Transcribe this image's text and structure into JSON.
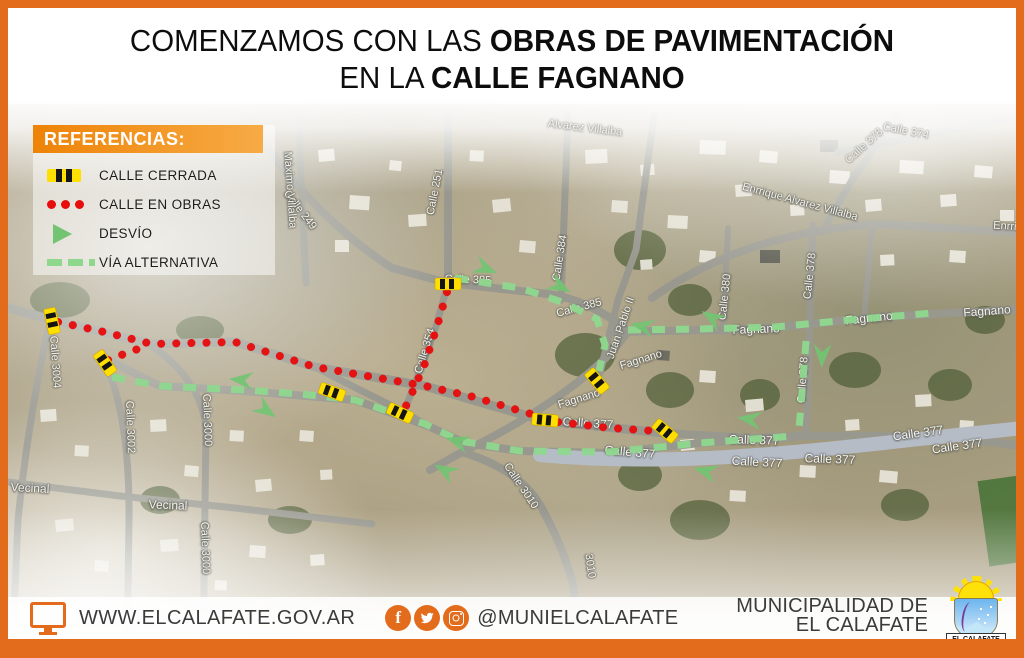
{
  "header": {
    "title_line1_regular": "COMENZAMOS CON LAS ",
    "title_line1_bold": "OBRAS DE PAVIMENTACIÓN",
    "title_line2_regular": "EN LA ",
    "title_line2_bold": "CALLE FAGNANO"
  },
  "legend": {
    "title": "REFERENCIAS:",
    "items": [
      {
        "type": "closed",
        "label": "CALLE CERRADA"
      },
      {
        "type": "works",
        "label": "CALLE EN OBRAS"
      },
      {
        "type": "detour",
        "label": "DESVÍO"
      },
      {
        "type": "alternative",
        "label": "VÍA ALTERNATIVA"
      }
    ]
  },
  "colors": {
    "accent_orange": "#e26b1c",
    "closed_yellow": "#ffdf00",
    "works_red": "#e60d0d",
    "detour_green": "#72c472",
    "alternative_green": "#8ed88e"
  },
  "map": {
    "street_labels": [
      {
        "t": "Calle 249",
        "x": 300,
        "y": 210,
        "r": 52
      },
      {
        "t": "Máximo Villalba",
        "x": 290,
        "y": 190,
        "r": 86
      },
      {
        "t": "Calle 251",
        "x": 435,
        "y": 192,
        "r": -79
      },
      {
        "t": "Calle 384",
        "x": 560,
        "y": 258,
        "r": -81
      },
      {
        "t": "Alvarez Villalba",
        "x": 585,
        "y": 128,
        "r": 7,
        "f": 1
      },
      {
        "t": "Calle 374",
        "x": 906,
        "y": 131,
        "r": 11,
        "f": 1
      },
      {
        "t": "Calle 378",
        "x": 864,
        "y": 146,
        "r": -42,
        "f": 1
      },
      {
        "t": "Enrrique Alvarez Villalba",
        "x": 800,
        "y": 202,
        "r": 15
      },
      {
        "t": "Enrrique",
        "x": 1014,
        "y": 227,
        "r": 4
      },
      {
        "t": "Calle 380",
        "x": 725,
        "y": 297,
        "r": -84
      },
      {
        "t": "Calle 378",
        "x": 810,
        "y": 276,
        "r": -84
      },
      {
        "t": "Calle 378",
        "x": 803,
        "y": 380,
        "r": -86
      },
      {
        "t": "Juan Pablo II",
        "x": 621,
        "y": 328,
        "r": -71
      },
      {
        "t": "Calle 385",
        "x": 468,
        "y": 280,
        "r": 2
      },
      {
        "t": "Calle 385",
        "x": 579,
        "y": 308,
        "r": -15
      },
      {
        "t": "Fagnano",
        "x": 756,
        "y": 329,
        "r": -2,
        "s": 12
      },
      {
        "t": "Fagnano",
        "x": 869,
        "y": 318,
        "r": -6,
        "s": 12
      },
      {
        "t": "Fagnano",
        "x": 987,
        "y": 311,
        "r": -4,
        "s": 12
      },
      {
        "t": "Fagnano",
        "x": 579,
        "y": 399,
        "r": -17
      },
      {
        "t": "Fagnano",
        "x": 641,
        "y": 360,
        "r": -17
      },
      {
        "t": "Calle 354",
        "x": 425,
        "y": 351,
        "r": -73
      },
      {
        "t": "Calle 377",
        "x": 588,
        "y": 423,
        "r": 4,
        "s": 12
      },
      {
        "t": "Calle 377",
        "x": 630,
        "y": 452,
        "r": 5,
        "s": 12
      },
      {
        "t": "Calle 377",
        "x": 754,
        "y": 440,
        "r": 2,
        "s": 12
      },
      {
        "t": "Calle 377",
        "x": 757,
        "y": 462,
        "r": 3,
        "s": 12
      },
      {
        "t": "Calle 377",
        "x": 830,
        "y": 459,
        "r": 2,
        "s": 12
      },
      {
        "t": "Calle 377",
        "x": 918,
        "y": 433,
        "r": -8,
        "s": 12
      },
      {
        "t": "Calle 377",
        "x": 957,
        "y": 446,
        "r": -8,
        "s": 12
      },
      {
        "t": "Calle 3004",
        "x": 55,
        "y": 362,
        "r": 86
      },
      {
        "t": "Calle 3002",
        "x": 130,
        "y": 427,
        "r": 88
      },
      {
        "t": "Calle 3000",
        "x": 207,
        "y": 420,
        "r": 88
      },
      {
        "t": "Calle 3000",
        "x": 205,
        "y": 548,
        "r": 88
      },
      {
        "t": "Vecinal",
        "x": 30,
        "y": 488,
        "r": 3,
        "s": 12
      },
      {
        "t": "Vecinal",
        "x": 168,
        "y": 505,
        "r": 2,
        "s": 12
      },
      {
        "t": "Calle 3010",
        "x": 521,
        "y": 486,
        "r": 56
      },
      {
        "t": "3010",
        "x": 590,
        "y": 566,
        "r": 82
      }
    ],
    "closures": [
      {
        "x": 52,
        "y": 321,
        "r": 78
      },
      {
        "x": 105,
        "y": 363,
        "r": 55
      },
      {
        "x": 332,
        "y": 392,
        "r": 20
      },
      {
        "x": 400,
        "y": 413,
        "r": 25
      },
      {
        "x": 448,
        "y": 284,
        "r": 0
      },
      {
        "x": 545,
        "y": 420,
        "r": 5
      },
      {
        "x": 665,
        "y": 431,
        "r": 40
      },
      {
        "x": 597,
        "y": 381,
        "r": 50
      }
    ],
    "works_routes": [
      [
        [
          58,
          322
        ],
        [
          100,
          331
        ],
        [
          152,
          344
        ],
        [
          235,
          342
        ],
        [
          315,
          367
        ],
        [
          425,
          386
        ],
        [
          470,
          396
        ],
        [
          538,
          416
        ]
      ],
      [
        [
          558,
          422
        ],
        [
          610,
          428
        ],
        [
          656,
          431
        ]
      ],
      [
        [
          108,
          360
        ],
        [
          132,
          351
        ],
        [
          150,
          345
        ]
      ],
      [
        [
          447,
          292
        ],
        [
          436,
          330
        ],
        [
          424,
          366
        ],
        [
          412,
          393
        ],
        [
          405,
          408
        ]
      ]
    ],
    "alt_routes": [
      [
        [
          112,
          377
        ],
        [
          160,
          386
        ],
        [
          245,
          390
        ],
        [
          300,
          394
        ],
        [
          355,
          400
        ],
        [
          425,
          424
        ],
        [
          460,
          441
        ],
        [
          520,
          451
        ],
        [
          610,
          452
        ],
        [
          700,
          443
        ],
        [
          795,
          436
        ]
      ],
      [
        [
          455,
          278
        ],
        [
          520,
          288
        ],
        [
          562,
          302
        ],
        [
          597,
          319
        ],
        [
          605,
          345
        ],
        [
          599,
          371
        ]
      ],
      [
        [
          628,
          330
        ],
        [
          700,
          329
        ],
        [
          775,
          327
        ],
        [
          860,
          319
        ],
        [
          933,
          313
        ]
      ],
      [
        [
          806,
          341
        ],
        [
          803,
          380
        ],
        [
          799,
          430
        ]
      ]
    ],
    "detour_arrows": [
      {
        "x": 487,
        "y": 269,
        "r": 22
      },
      {
        "x": 561,
        "y": 287,
        "r": 28
      },
      {
        "x": 641,
        "y": 326,
        "r": 192
      },
      {
        "x": 711,
        "y": 317,
        "r": 212
      },
      {
        "x": 822,
        "y": 357,
        "r": 92
      },
      {
        "x": 748,
        "y": 419,
        "r": 188
      },
      {
        "x": 704,
        "y": 471,
        "r": 195
      },
      {
        "x": 240,
        "y": 380,
        "r": 185
      },
      {
        "x": 267,
        "y": 411,
        "r": 35
      },
      {
        "x": 456,
        "y": 441,
        "r": 197
      },
      {
        "x": 444,
        "y": 470,
        "r": 210
      }
    ]
  },
  "footer": {
    "website": "WWW.ELCALAFATE.GOV.AR",
    "social_handle": "@MUNIELCALAFATE",
    "social_icons": [
      "facebook-icon",
      "twitter-icon",
      "instagram-icon"
    ],
    "org_line1": "MUNICIPALIDAD DE",
    "org_line2": "EL CALAFATE",
    "logo_caption": "EL CALAFATE"
  }
}
